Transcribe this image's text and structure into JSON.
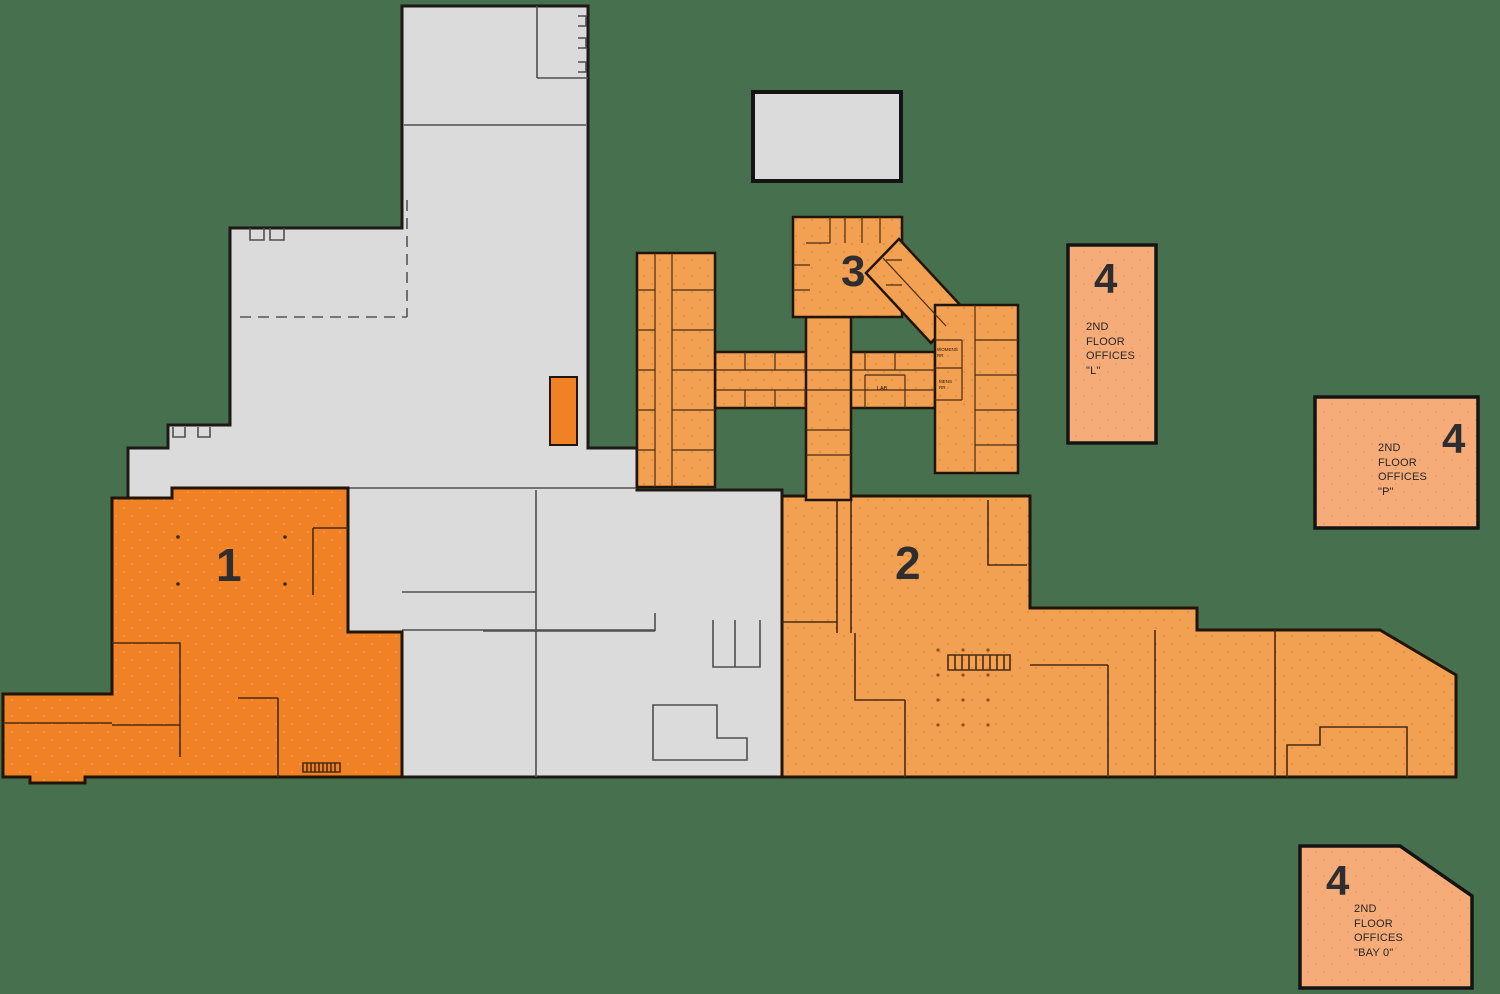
{
  "title": "Facility floor plan with numbered zones",
  "background_color": "#47704E",
  "colors": {
    "zone1_fill": "#F08125",
    "zone2_fill": "#F2A052",
    "zone3_fill": "#F2A052",
    "office_box_fill": "#F6AC79",
    "building_fill": "#DBDBDB",
    "wall_outline": "#1D1A16"
  },
  "zones": {
    "zone1": {
      "label": "1"
    },
    "zone2": {
      "label": "2"
    },
    "zone3": {
      "label": "3"
    }
  },
  "rooms": {
    "womens_rr": "WOMENS\nRR",
    "mens_rr": "MENS\nRR",
    "lab": "LAB"
  },
  "offices": {
    "l": {
      "number": "4",
      "text": "2ND\nFLOOR\nOFFICES\n\"L\""
    },
    "p": {
      "number": "4",
      "text": "2ND\nFLOOR\nOFFICES\n\"P\""
    },
    "bay0": {
      "number": "4",
      "text": "2ND\nFLOOR\nOFFICES\n\"BAY 0\""
    }
  }
}
